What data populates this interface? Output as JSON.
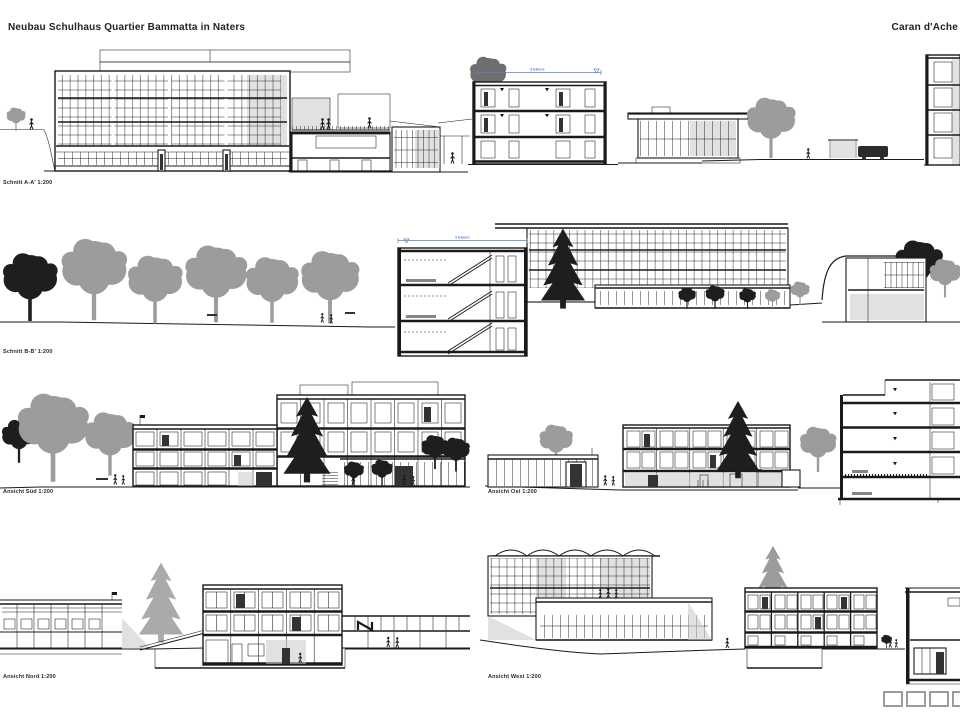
{
  "sheet": {
    "title": "Neubau Schulhaus Quartier Bammatta in Naters",
    "author": "Caran d'Ache"
  },
  "colors": {
    "line": "#1a1a1a",
    "dimension_blue": "#5b7fd0",
    "tree_gray": "#9c9c9c",
    "tree_dark": "#1e1e1e",
    "shade_gray": "#c8c8c8"
  },
  "drawings": {
    "schnitt_aa": {
      "label": "Schnitt A-A' 1:200",
      "dimension_note": "3 Ebene"
    },
    "schnitt_bb": {
      "label": "Schnitt B-B' 1:200",
      "dimension_note": "3 Ebene"
    },
    "ansicht_sued": {
      "label": "Ansicht Süd 1:200"
    },
    "ansicht_ost": {
      "label": "Ansicht Ost 1:200"
    },
    "ansicht_nord": {
      "label": "Ansicht Nord 1:200"
    },
    "ansicht_west": {
      "label": "Ansicht West 1:200"
    }
  },
  "footer": {
    "legend_box_count": 4
  }
}
